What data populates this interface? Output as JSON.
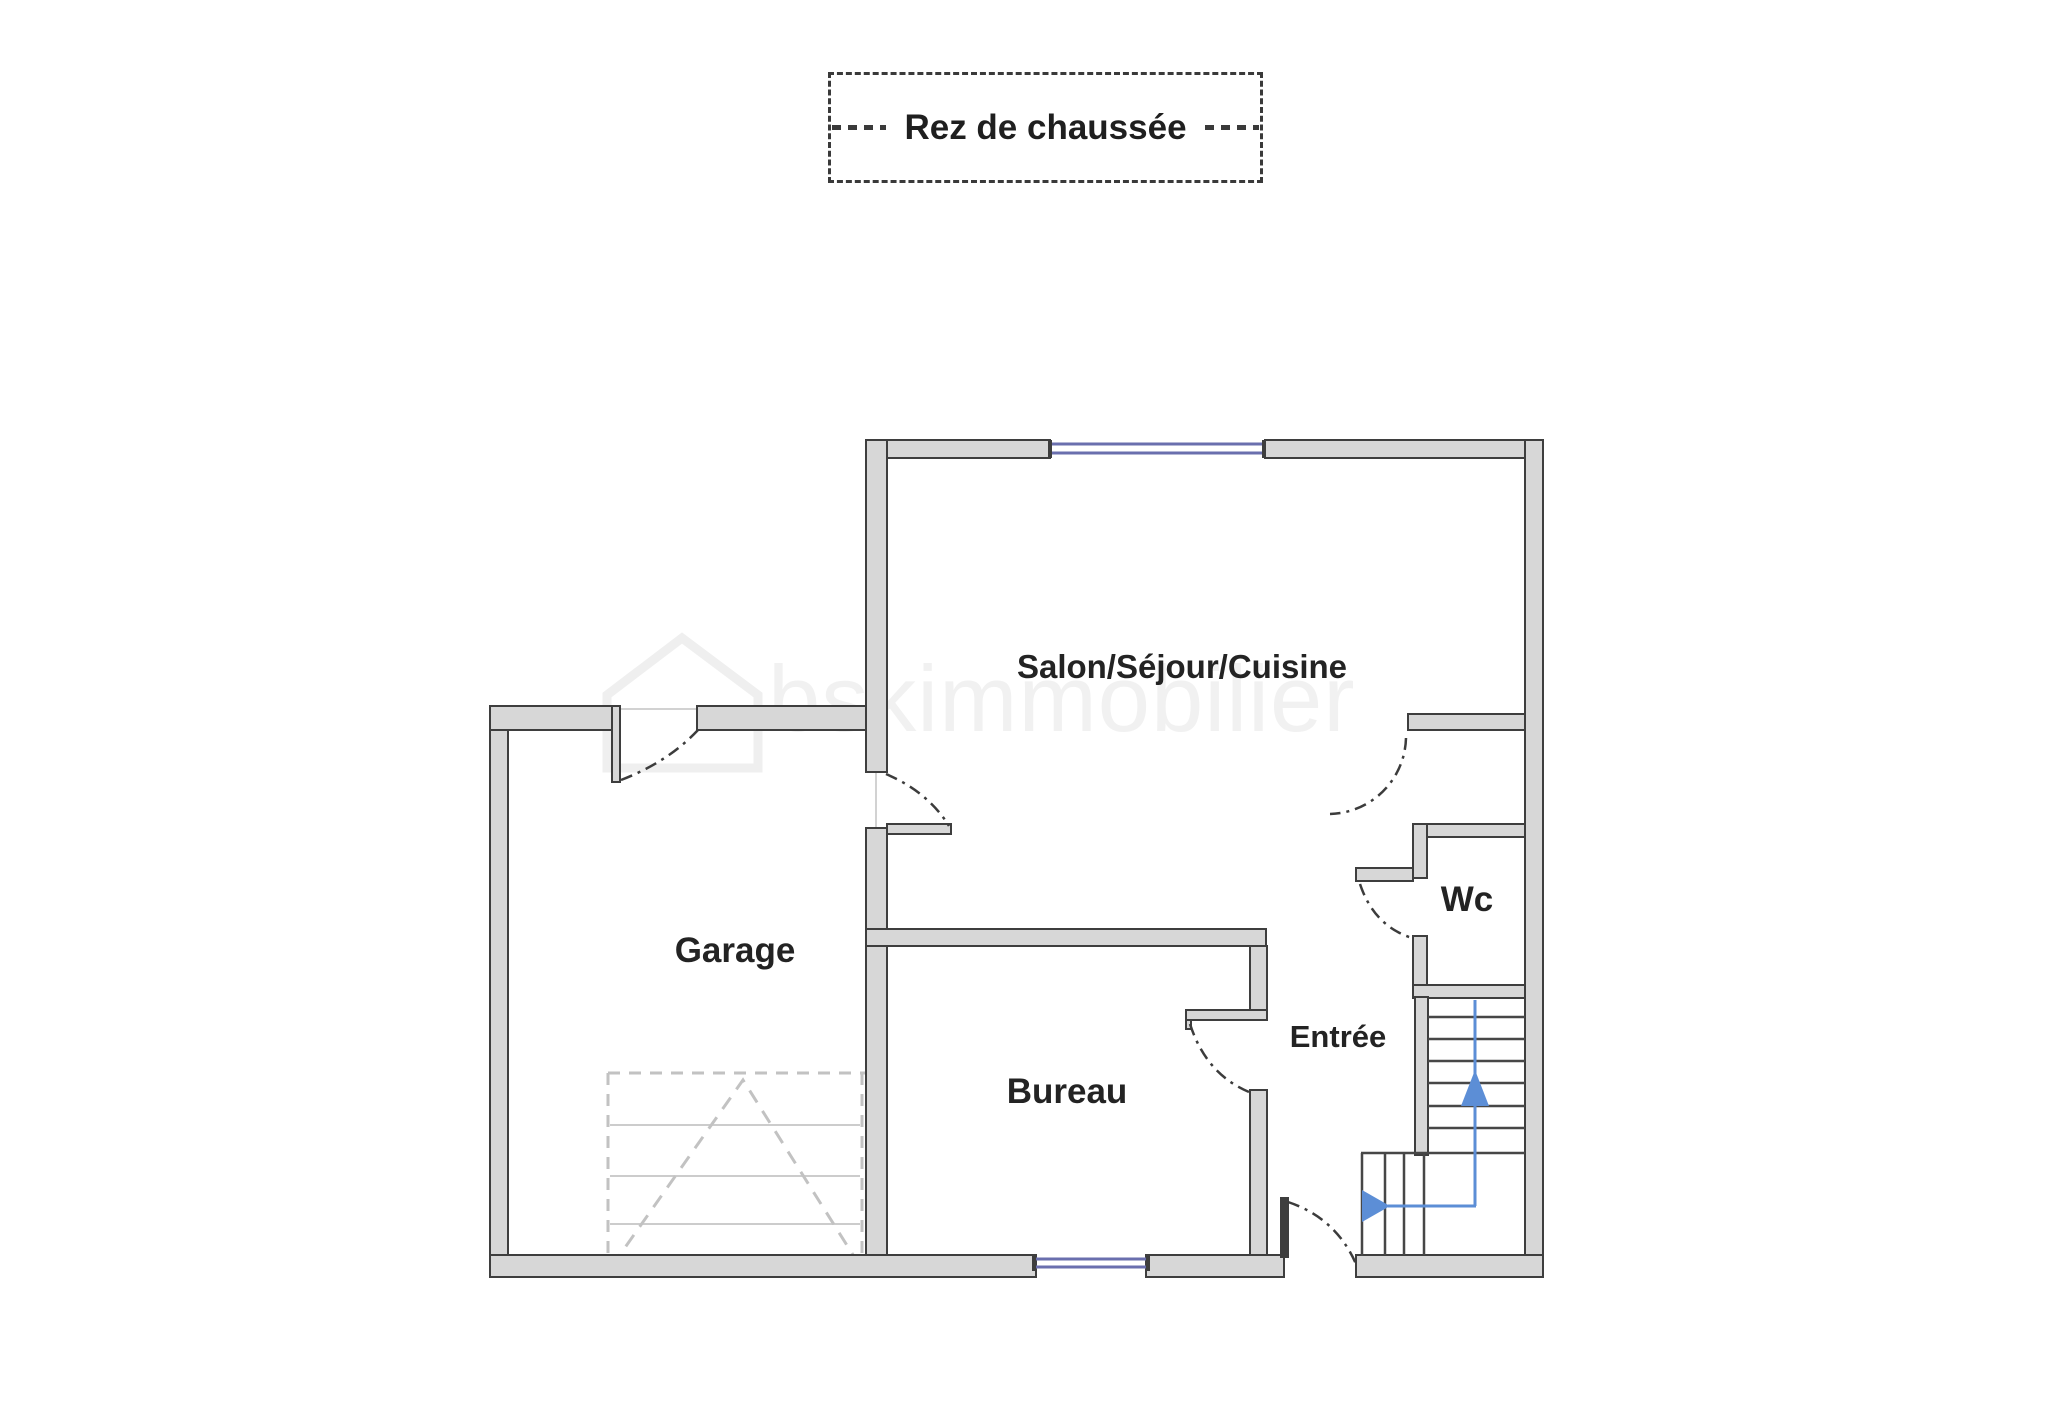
{
  "title": {
    "label": "Rez de chaussée"
  },
  "rooms": [
    {
      "id": "salon",
      "label": "Salon/Séjour/Cuisine"
    },
    {
      "id": "garage",
      "label": "Garage"
    },
    {
      "id": "bureau",
      "label": "Bureau"
    },
    {
      "id": "entree",
      "label": "Entrée"
    },
    {
      "id": "wc",
      "label": "Wc"
    }
  ],
  "watermark": {
    "text": "bskimmobilier"
  },
  "stairs": {
    "direction": "up",
    "arrow_color": "#5c8ed6"
  },
  "colors": {
    "wall_fill": "#d7d7d7",
    "wall_edge": "#3e3e3e",
    "window_blue": "#6a6fae",
    "stair_arrow_blue": "#5c8ed6",
    "garage_door_dashed": "#c2c2c2",
    "door_arc": "#3c3c3c",
    "watermark_gray": "#f1f1f1",
    "label_text": "#232323",
    "background": "#ffffff"
  }
}
